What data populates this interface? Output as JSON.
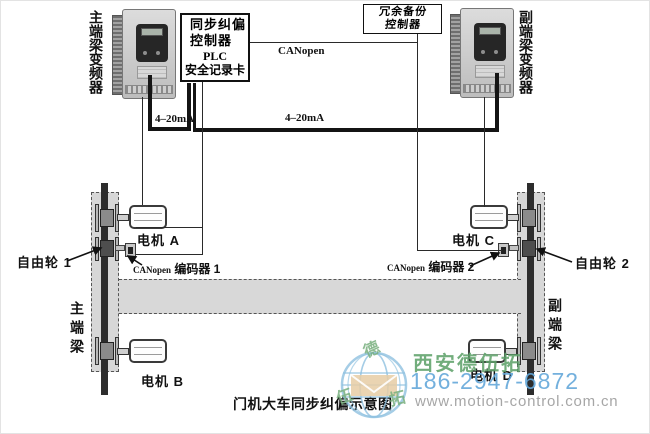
{
  "diagram": {
    "caption": "门机大车同步纠偏示意图",
    "left_vfd_label": "主端梁变频器",
    "right_vfd_label": "副端梁变频器",
    "plc_box": {
      "line1": "同步纠偏",
      "line2": "控制器",
      "line3": "PLC",
      "line4": "安全记录卡"
    },
    "backup_box": {
      "line1": "冗余备份",
      "line2": "控制器"
    },
    "bus_labels": {
      "canopen": "CANopen",
      "ma_left": "4–20mA",
      "ma_right": "4–20mA"
    },
    "motors": {
      "a": "电机 A",
      "b": "电机 B",
      "c": "电机 C",
      "d": "电机 D"
    },
    "encoder1": {
      "prefix": "CANopen",
      "name": " 编码器 1"
    },
    "encoder2": {
      "prefix": "CANopen",
      "name": " 编码器 2"
    },
    "free_wheel1": "自由轮 1",
    "free_wheel2": "自由轮 2",
    "beam_left": "主端梁",
    "beam_right": "副端梁"
  },
  "watermark": {
    "company": "西安德伍拓",
    "phone": "186-2947-6872",
    "website": "www.motion-control.com.cn",
    "logo_char_top": "德",
    "logo_char_left": "伍",
    "logo_char_right": "拓",
    "colors": {
      "company": "#5fa26b",
      "phone": "#64a8da",
      "website": "#a2a2a2",
      "globe": "#8fc1e0",
      "envelope": "#e6cda4",
      "logo_chars": "#79b07e"
    }
  }
}
